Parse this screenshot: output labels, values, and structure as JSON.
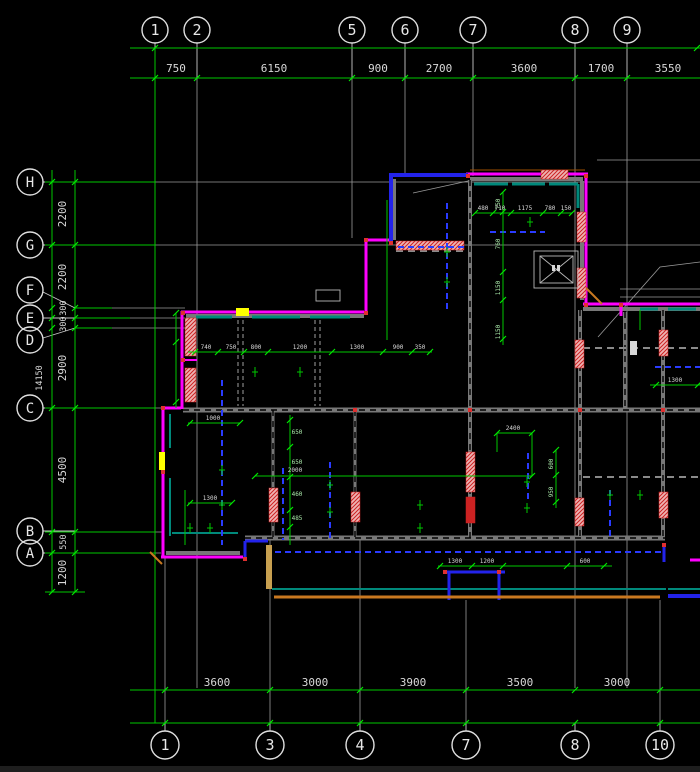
{
  "axes": {
    "top": {
      "bubbles": [
        "1",
        "2",
        "5",
        "6",
        "7",
        "8",
        "9"
      ],
      "dims": [
        "750",
        "6150",
        "900",
        "2700",
        "3600",
        "1700",
        "3550"
      ]
    },
    "bottom": {
      "bubbles": [
        "1",
        "3",
        "4",
        "7",
        "8",
        "10"
      ],
      "dims": [
        "3600",
        "3000",
        "3900",
        "3500",
        "3000"
      ]
    },
    "left": {
      "bubbles": [
        "H",
        "G",
        "F",
        "E",
        "D",
        "C",
        "B",
        "A"
      ],
      "dims": [
        "2200",
        "2200",
        "300",
        "300",
        "2900",
        "4500",
        "550",
        "1200"
      ],
      "overall_dim": "14150"
    }
  },
  "interior": {
    "chain_top_room": [
      "740",
      "750",
      "800",
      "1200",
      "1300",
      "900",
      "350"
    ],
    "chain_left_room_v": [
      "650",
      "650",
      "460",
      "485"
    ],
    "chain_mid_h": [
      "480",
      "710",
      "1175",
      "780",
      "150"
    ],
    "chain_mid_v": [
      "750",
      "760",
      "1150",
      "1150"
    ],
    "chain_bottom_h": [
      "1300",
      "1200",
      "600"
    ],
    "chain_right_v": [
      "600",
      "950"
    ],
    "dim_2400": "2400",
    "dim_2000": "2000",
    "dim_1000": "1000",
    "dim_1300a": "1300",
    "dim_1300b": "1300"
  },
  "colors": {
    "background": "#000000",
    "wall_outline": "#ff00ff",
    "beam_blue": "#2a3bff",
    "dim_green": "#00c800",
    "axis_gray": "#9a9a9a",
    "wall_fill": "#787878",
    "hatch_red": "#cc2222",
    "lining_teal": "#00897b",
    "band_orange": "#c87820",
    "highlight_yellow": "#ffff00"
  }
}
